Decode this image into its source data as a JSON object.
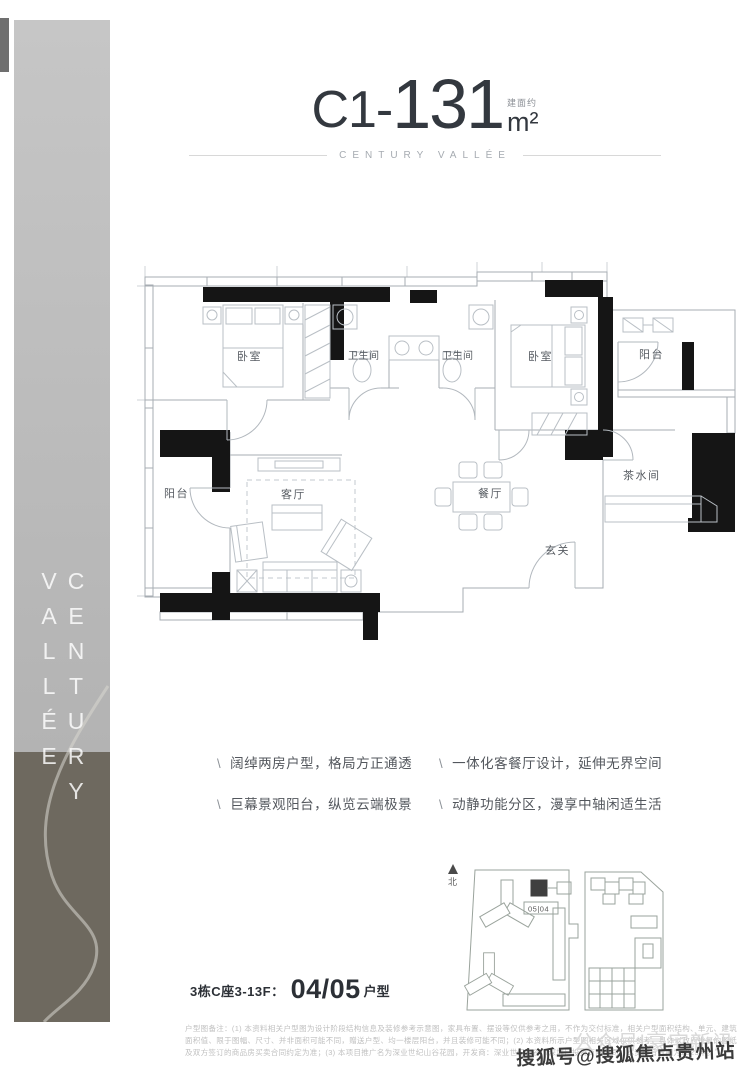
{
  "header": {
    "unit_code": "C1-",
    "area_value": "131",
    "area_prefix": "建面约",
    "area_unit": "m²",
    "subtitle": "CENTURY VALLÉE"
  },
  "sidebar": {
    "vertical_text": "CENTURY VALLÉE"
  },
  "floorplan": {
    "rooms": [
      {
        "label": "卧室"
      },
      {
        "label": "卫生间"
      },
      {
        "label": "卫生间"
      },
      {
        "label": "卧室"
      },
      {
        "label": "阳台"
      },
      {
        "label": "茶水间"
      },
      {
        "label": "阳台"
      },
      {
        "label": "客厅"
      },
      {
        "label": "餐厅"
      },
      {
        "label": "玄关"
      }
    ]
  },
  "features": {
    "bullet": "\\",
    "items": [
      "阔绰两房户型，格局方正通透",
      "巨幕景观阳台，纵览云端极景",
      "一体化客餐厅设计，延伸无界空间",
      "动静功能分区，漫享中轴闲适生活"
    ]
  },
  "unit_info": {
    "prefix": "3栋C座3-13F：",
    "number": "04/05",
    "suffix": "户型"
  },
  "site_plan": {
    "north_label": "北",
    "unit_label": "05|04"
  },
  "disclaimer": "户型图备注：(1) 本资料相关户型图为设计阶段结构信息及装修参考示意图，家具布置、摆设等仅供参考之用，不作为交付标准，相关户型面积结构、单元、建筑面积值、限于图幅、尺寸、并非面积可能不同，赠送户型、均一楼层阳台，并且装修可能不同；(2) 本资料所示户型图相关区域仅供参考，具体以政府批复的图纸及双方签订的商品房买卖合同约定为准；(3) 本项目推广名为深业世纪山谷花园，开发商：深业世纪山谷（深圳）投资有限公司，本资料有效期为2023年。",
  "watermarks": {
    "primary": "搜狐号@搜狐焦点贵州站",
    "secondary": "公众号|豪宅新讯"
  },
  "colors": {
    "wall_black": "#151515",
    "sidebar_dark": "#6e695f",
    "sidebar_light": "#b9b9b9"
  }
}
